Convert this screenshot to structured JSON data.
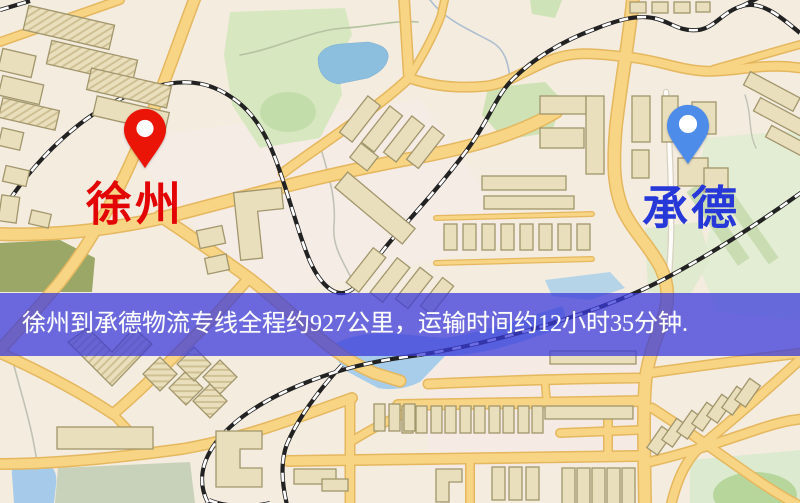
{
  "banner": {
    "text": "徐州到承德物流专线全程约927公里，运输时间约12小时35分钟.",
    "background": "#3a3ada",
    "text_color": "#ffffff"
  },
  "markers": {
    "origin": {
      "label": "徐州",
      "pin_color": "#ea1407",
      "label_color": "#e30505"
    },
    "destination": {
      "label": "承德",
      "pin_color": "#4e8cea",
      "label_color": "#2738d9"
    }
  },
  "map": {
    "palette": {
      "background": "#f4ecdf",
      "road_yellow": "#f7d584",
      "road_casing": "#e5b75e",
      "road_white": "#fdfcf8",
      "railway": "#222222",
      "water": "#a8cdeb",
      "pond": "#8cbede",
      "park_green": "#d7e7c0",
      "pale_green": "#e3edd4",
      "olive_green": "#9aa766",
      "building_fill": "#e9dfbd",
      "building_stroke": "#a2966c"
    }
  }
}
